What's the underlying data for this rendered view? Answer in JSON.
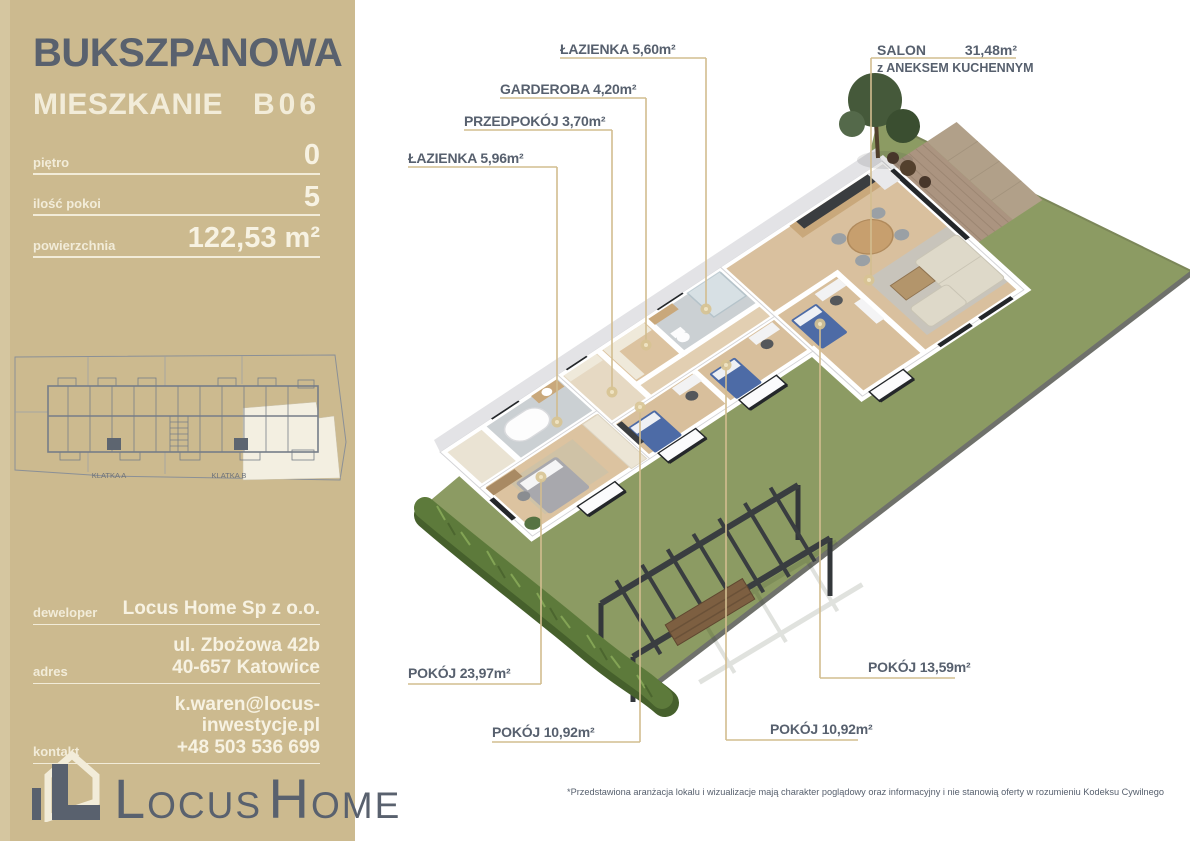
{
  "sidebar": {
    "project_name": "BUKSZPANOWA",
    "unit_label": "MIESZKANIE",
    "unit_number": "B06",
    "specs": [
      {
        "label": "piętro",
        "value": "0"
      },
      {
        "label": "ilość pokoi",
        "value": "5"
      },
      {
        "label": "powierzchnia",
        "value": "122,53 m²"
      }
    ],
    "mini_plan": {
      "klatka_a": "KLATKA A",
      "klatka_b": "KLATKA B"
    },
    "contact": [
      {
        "label": "deweloper",
        "lines": [
          "Locus Home Sp z o.o."
        ]
      },
      {
        "label": "adres",
        "lines": [
          "ul. Zbożowa 42b",
          "40-657 Katowice"
        ]
      },
      {
        "label": "kontakt",
        "lines": [
          "k.waren@locus-inwestycje.pl",
          "+48 503 536 699"
        ]
      }
    ],
    "logo": {
      "word1_initial": "L",
      "word1_rest": "OCUS",
      "word2_initial": "H",
      "word2_rest": "OME"
    }
  },
  "plan": {
    "labels": {
      "lazienka_560": "ŁAZIENKA 5,60m²",
      "garderoba": "GARDEROBA 4,20m²",
      "przedpokoj": "PRZEDPOKÓJ 3,70m²",
      "lazienka_596": "ŁAZIENKA 5,96m²",
      "pokoj_2397": "POKÓJ 23,97m²",
      "pokoj_1092_a": "POKÓJ 10,92m²",
      "pokoj_1092_b": "POKÓJ 10,92m²",
      "pokoj_1359": "POKÓJ 13,59m²"
    },
    "salon": {
      "name": "SALON",
      "area": "31,48m²",
      "sub": "z ANEKSEM KUCHENNYM"
    },
    "disclaimer": "*Przedstawiona aranżacja lokalu i wizualizacje mają charakter poglądowy oraz informacyjny i nie stanowią oferty w rozumieniu Kodeksu Cywilnego"
  },
  "colors": {
    "sidebar_bg": "#ccba8f",
    "accent_dark": "#59616e",
    "cream": "#f2ecd9",
    "garden_green": "#8c9b63",
    "leader_tan": "#d2bd8f",
    "wood_floor": "#d8bf9c"
  }
}
